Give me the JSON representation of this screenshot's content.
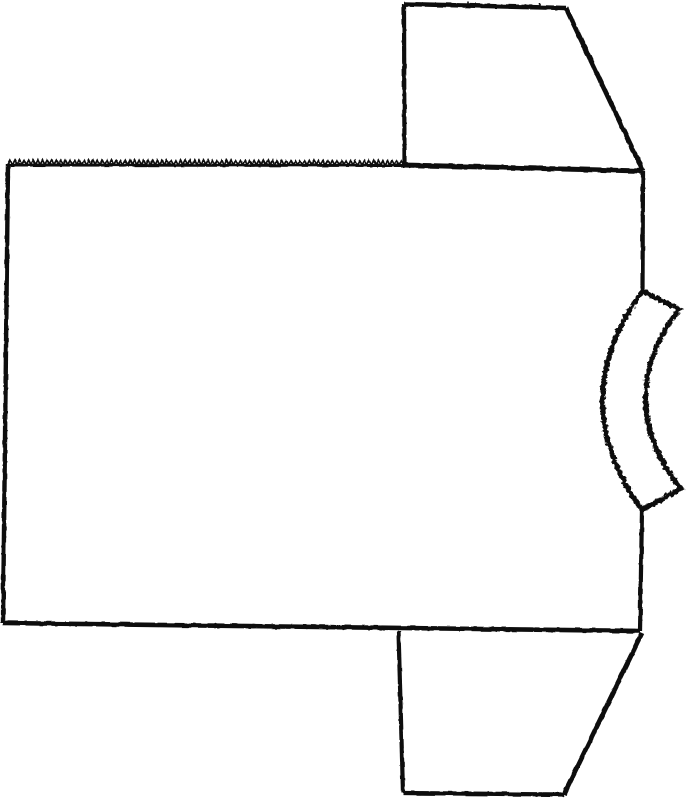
{
  "canvas": {
    "width": 687,
    "height": 800
  },
  "colors": {
    "ink": "#0c0c0c",
    "paper": "#ffffff"
  },
  "filters": [
    {
      "id": "rough-light",
      "base_frequency": 0.11,
      "octaves": 2,
      "scale": 2.2,
      "seed": 7
    },
    {
      "id": "rough-heavy",
      "base_frequency": 0.28,
      "octaves": 3,
      "scale": 5.0,
      "seed": 11
    }
  ],
  "diagram": {
    "description": "Scanned-style black line drawing of a T-shirt sewing pattern lying on its side: rectangular body piece with a pinked (serrated) top edge, trapezoid sleeve pieces at top right and bottom right, and a curved fuzzy-edged neckband strip bulging from the middle of the right edge.",
    "strokes": [
      {
        "name": "body-top-serrated-baseline",
        "type": "path",
        "d": "M 8 165 L 405 165.5",
        "stroke_width": 3,
        "filter": "rough-light"
      },
      {
        "name": "body-top-serrated-teeth",
        "type": "zigzag",
        "x1": 8,
        "y1": 164.5,
        "x2": 405,
        "y2": 165,
        "tooth_width": 4.6,
        "tooth_height": 4.4,
        "stroke_width": 1.7,
        "filter": "rough-light"
      },
      {
        "name": "body-left-edge",
        "type": "path",
        "d": "M 8 164 L 3 623",
        "stroke_width": 4.4,
        "filter": "rough-light"
      },
      {
        "name": "body-bottom-edge",
        "type": "path",
        "d": "M 3 623 L 640 631",
        "stroke_width": 4.6,
        "filter": "rough-light"
      },
      {
        "name": "body-right-edge-upper",
        "type": "path",
        "d": "M 643 171 L 642.5 291",
        "stroke_width": 4.2,
        "filter": "rough-light"
      },
      {
        "name": "body-right-edge-lower",
        "type": "path",
        "d": "M 642 510 L 640 631",
        "stroke_width": 4.2,
        "filter": "rough-light"
      },
      {
        "name": "shoulder-seam-line",
        "type": "path",
        "d": "M 403 165 L 643 171",
        "stroke_width": 5,
        "filter": "rough-light"
      },
      {
        "name": "top-sleeve-left-edge",
        "type": "path",
        "d": "M 404.5 164 L 404 4",
        "stroke_width": 4.2,
        "filter": "rough-light"
      },
      {
        "name": "top-sleeve-top-edge",
        "type": "path",
        "d": "M 404 4 L 566 8",
        "stroke_width": 4.6,
        "filter": "rough-light"
      },
      {
        "name": "top-sleeve-notch-tick-1",
        "type": "path",
        "d": "M 468 6 L 468 1.5",
        "stroke_width": 1.6,
        "filter": "rough-light"
      },
      {
        "name": "top-sleeve-notch-tick-2",
        "type": "path",
        "d": "M 540 7.5 L 540 3",
        "stroke_width": 1.6,
        "filter": "rough-light"
      },
      {
        "name": "top-sleeve-slant-edge",
        "type": "path",
        "d": "M 566 8 L 643 171",
        "stroke_width": 4.8,
        "filter": "rough-light"
      },
      {
        "name": "bottom-sleeve-left-edge",
        "type": "path",
        "d": "M 398.5 631 L 403 793",
        "stroke_width": 4.2,
        "filter": "rough-light"
      },
      {
        "name": "bottom-sleeve-bottom-edge",
        "type": "path",
        "d": "M 403 793 L 564 794.5",
        "stroke_width": 4.2,
        "filter": "rough-light"
      },
      {
        "name": "bottom-sleeve-slant-edge",
        "type": "path",
        "d": "M 564 794.5 L 642 633",
        "stroke_width": 4.8,
        "filter": "rough-light"
      },
      {
        "name": "neckband-strip-outline",
        "type": "path",
        "d": "M 642.5 291 L 679 309 Q 611 400 681 489 L 642 510 Q 563 400 642.5 291 Z",
        "stroke_width": 5,
        "fill": "#ffffff",
        "filter": "rough-heavy"
      }
    ]
  }
}
